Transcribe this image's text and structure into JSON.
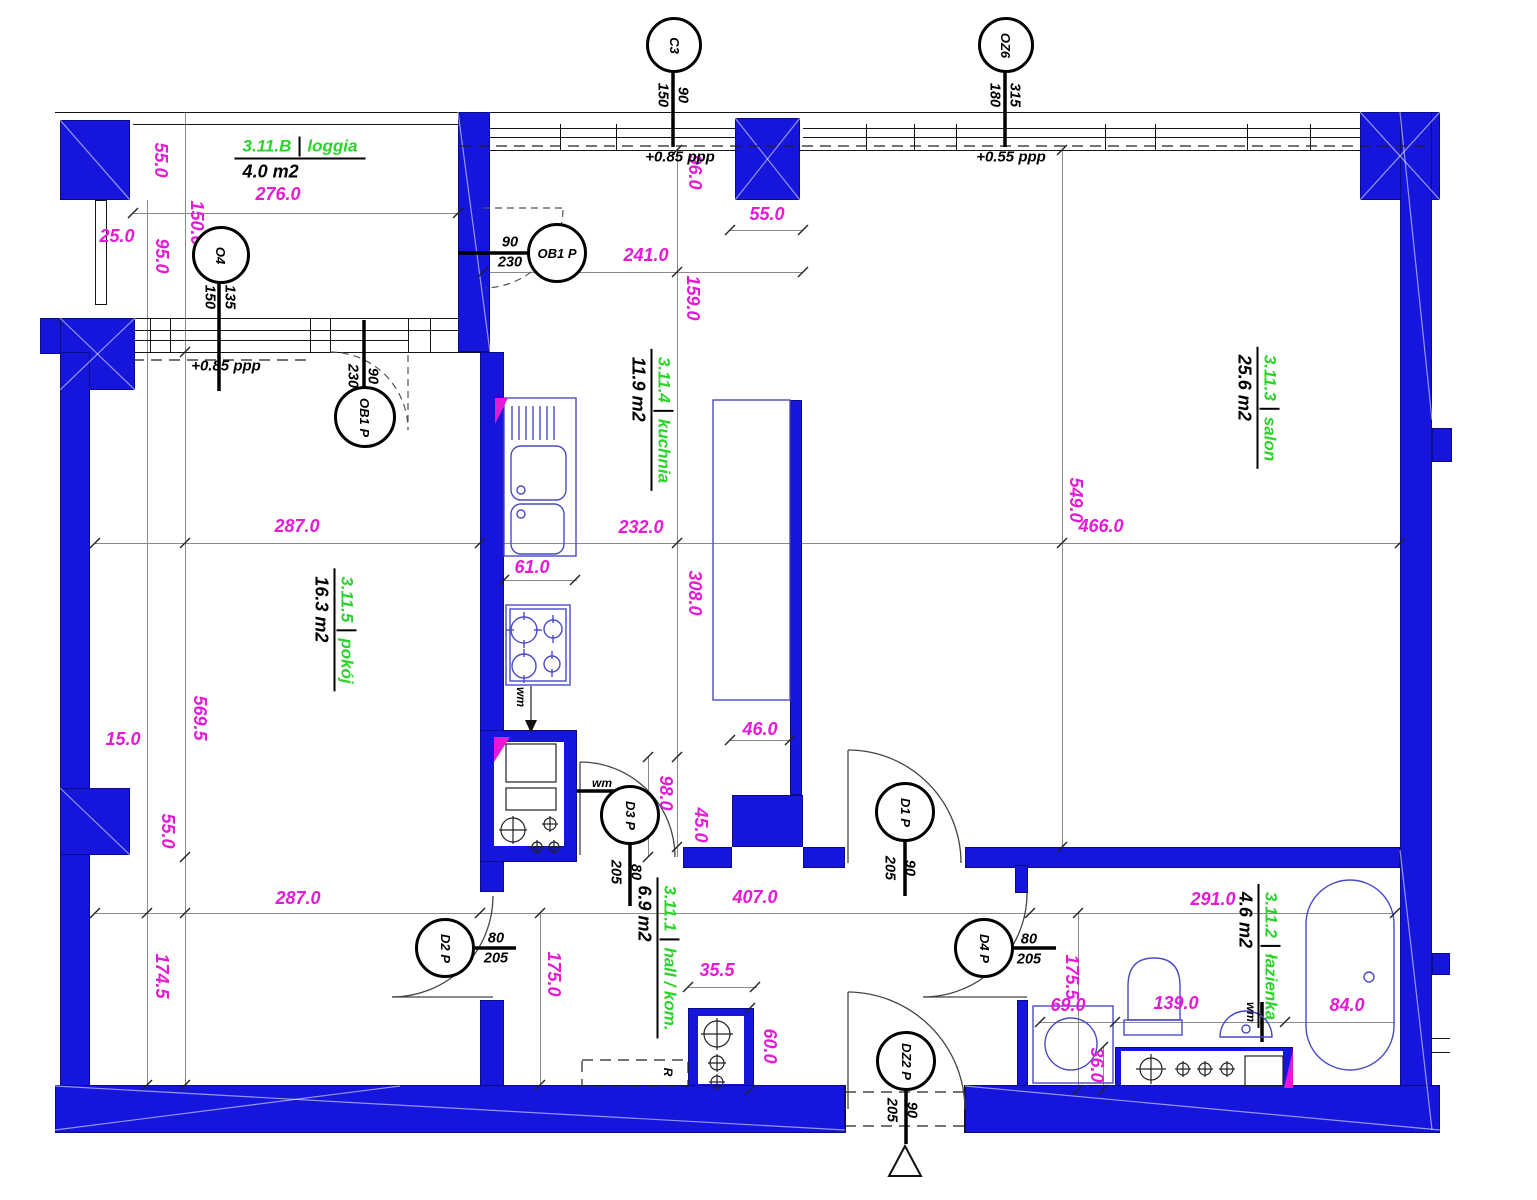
{
  "rooms": {
    "loggia": {
      "id": "3.11.B",
      "name": "loggia",
      "area": "4.0 m2"
    },
    "pokoj": {
      "id": "3.11.5",
      "name": "pokój",
      "area": "16.3 m2"
    },
    "kuchnia": {
      "id": "3.11.4",
      "name": "kuchnia",
      "area": "11.9 m2"
    },
    "salon": {
      "id": "3.11.3",
      "name": "salon",
      "area": "25.6 m2"
    },
    "hall": {
      "id": "3.11.1",
      "name": "hall / kom.",
      "area": "6.9 m2"
    },
    "lazienka": {
      "id": "3.11.2",
      "name": "łazienka",
      "area": "4.6 m2"
    }
  },
  "tags": {
    "o4": {
      "label": "O4",
      "a": "135",
      "b": "150"
    },
    "c3": {
      "label": "C3",
      "a": "90",
      "b": "150"
    },
    "oz6": {
      "label": "OZ6",
      "a": "315",
      "b": "180"
    },
    "ob1a": {
      "label": "OB1 P",
      "a": "90",
      "b": "230"
    },
    "ob1b": {
      "label": "OB1 P",
      "a": "90",
      "b": "230"
    },
    "d3": {
      "label": "D3 P",
      "a": "80",
      "b": "205"
    },
    "d1": {
      "label": "D1 P",
      "a": "90",
      "b": "205"
    },
    "d2": {
      "label": "D2 P",
      "a": "80",
      "b": "205"
    },
    "d4": {
      "label": "D4 P",
      "a": "80",
      "b": "205"
    },
    "dz2": {
      "label": "DZ2 P",
      "a": "90",
      "b": "205"
    }
  },
  "dims": {
    "l55": "55.0",
    "l150": "150.0",
    "l95": "95.0",
    "l25": "25.0",
    "l276": "276.0",
    "t96": "96.0",
    "t55": "55.0",
    "t241": "241.0",
    "t159": "159.0",
    "p287a": "287.0",
    "p5695": "569.5",
    "p15": "15.0",
    "p55": "55.0",
    "p287b": "287.0",
    "p1745": "174.5",
    "k61": "61.0",
    "k232": "232.0",
    "k308": "308.0",
    "k46": "46.0",
    "k98": "98.0",
    "k45": "45.0",
    "s549": "549.0",
    "s466": "466.0",
    "h407": "407.0",
    "h175": "175.0",
    "h355": "35.5",
    "h60": "60.0",
    "b291": "291.0",
    "b1755": "175.5",
    "b69": "69.0",
    "b36": "36.0",
    "b139": "139.0",
    "b84": "84.0"
  },
  "levels": {
    "top_left": "+0.85 ppp",
    "top_right": "+0.55 ppp",
    "loggia": "+0.85 ppp"
  },
  "notes": {
    "wm_kitchen": "wm",
    "wm_hall": "wm",
    "wm_bath": "wm",
    "radiator": "R"
  },
  "colors": {
    "wall": "#1515dc",
    "dim": "#e41ad6",
    "room_green": "#2bd32b",
    "fixture": "#4a4ac4"
  }
}
